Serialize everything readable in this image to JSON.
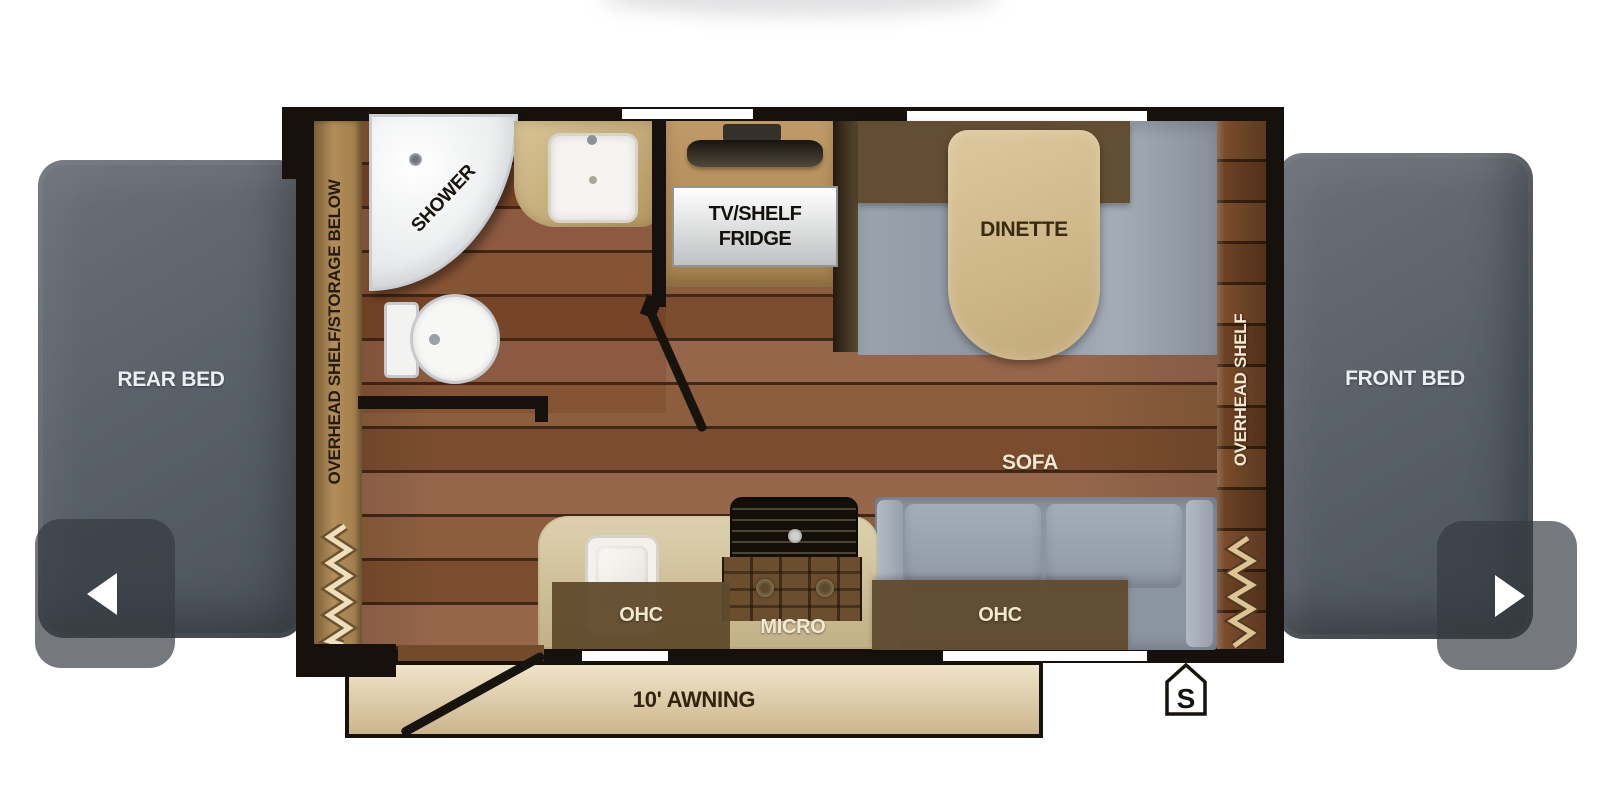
{
  "carousel": {
    "prev_icon": "chevron-left",
    "next_icon": "chevron-right"
  },
  "floorplan": {
    "rear_bed": "REAR BED",
    "front_bed": "FRONT BED",
    "left_shelf": "OVERHEAD SHELF/STORAGE BELOW",
    "right_shelf": "OVERHEAD SHELF",
    "shower": "SHOWER",
    "tv_line1": "TV/SHELF",
    "tv_line2": "FRIDGE",
    "dinette_ohc": "OHC",
    "dinette": "DINETTE",
    "sofa": "SOFA",
    "sofa_ohc": "OHC",
    "kitchen_ohc": "OHC",
    "micro": "MICRO",
    "awning": "10' AWNING",
    "spare_marker": "S",
    "colors": {
      "wall": "#16110c",
      "floor_wood": "#83553a",
      "shelf_tan": "#ab8754",
      "ohc_band": "#604a2c",
      "table_tan": "#cfb88c",
      "bench_gray": "#98a1ab",
      "sofa_gray": "#8d97a3",
      "bed_gray": "#575e66",
      "awning_tan": "#e3d3b2",
      "label_light": "#f3e8d0",
      "label_dark": "#241a0e"
    }
  }
}
